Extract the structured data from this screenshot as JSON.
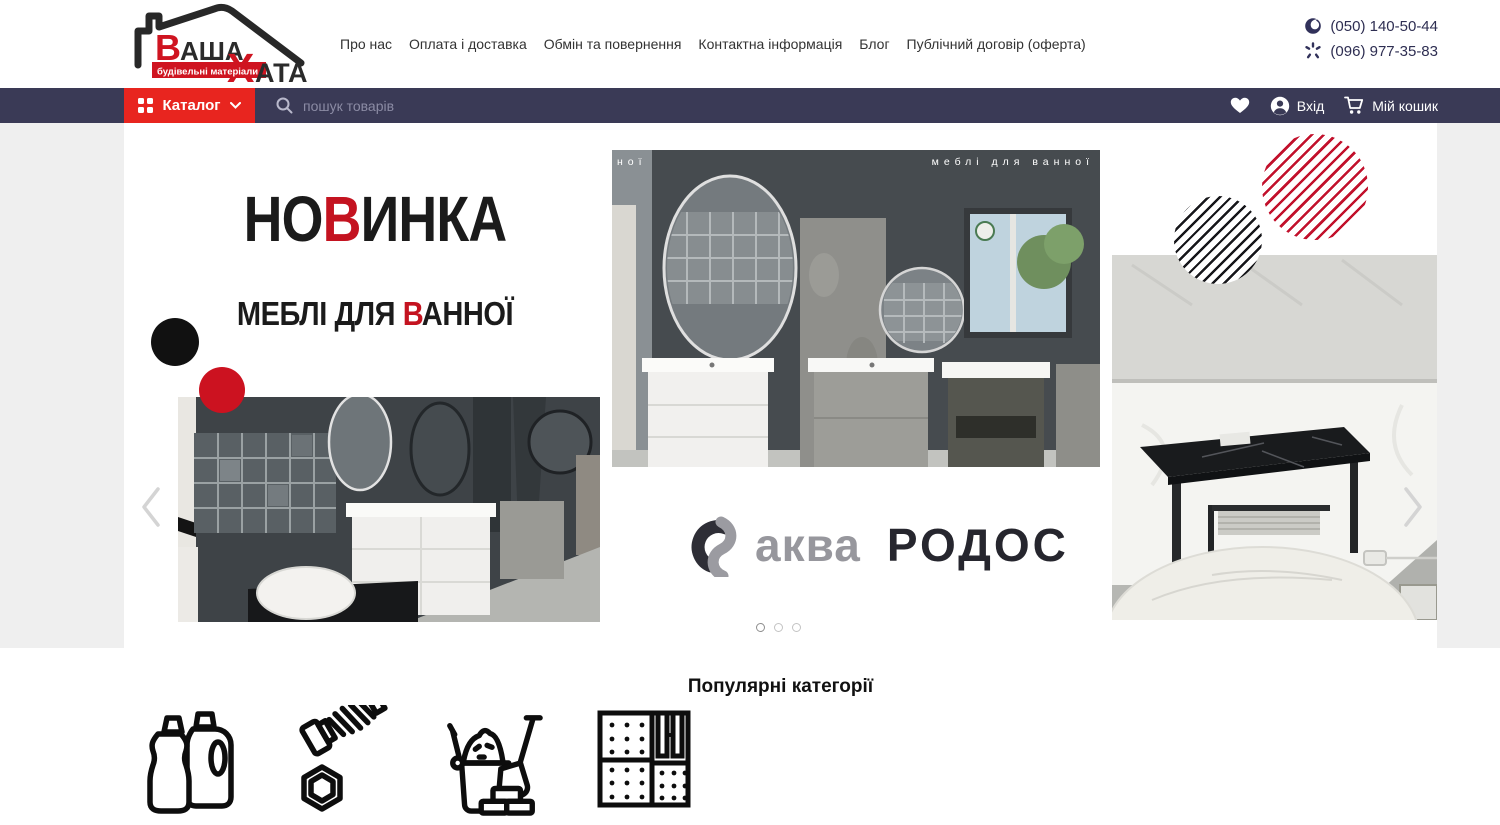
{
  "header": {
    "logo": {
      "word1_accent": "В",
      "word1_rest": "АША",
      "word2_accent": "Х",
      "word2_rest": "АТА",
      "tagline": "будівельні матеріали"
    },
    "nav": [
      {
        "label": "Про нас"
      },
      {
        "label": "Оплата і доставка"
      },
      {
        "label": "Обмін та повернення"
      },
      {
        "label": "Контактна інформація"
      },
      {
        "label": "Блог"
      },
      {
        "label": "Публічний договір (оферта)"
      }
    ],
    "phones": [
      {
        "carrier": "vodafone-icon",
        "number": "(050) 140-50-44"
      },
      {
        "carrier": "kyivstar-icon",
        "number": "(096) 977-35-83"
      }
    ]
  },
  "navbar": {
    "catalog_label": "Каталог",
    "search_placeholder": "пошук товарів",
    "login_label": "Вхід",
    "cart_label": "Мій кошик"
  },
  "hero": {
    "title_pre": "НО",
    "title_accent": "В",
    "title_post": "ИНКА",
    "subtitle_pre": "МЕБЛІ ДЛЯ ",
    "subtitle_accent": "В",
    "subtitle_post": "АННОЇ",
    "photo_caption": "меблі для ванної",
    "photo_caption_fragment": "ної",
    "brand_part1": "аква",
    "brand_part2": "РОДОС",
    "dots_count": 3,
    "active_dot": 1
  },
  "categories": {
    "heading": "Популярні категорії",
    "items": [
      {
        "name": "household-chemicals"
      },
      {
        "name": "fasteners"
      },
      {
        "name": "building-materials"
      },
      {
        "name": "insulation-panels"
      }
    ]
  },
  "colors": {
    "accent_red": "#e8251f",
    "title_red": "#c41320",
    "navbar_dark": "#3a3a56",
    "page_gray": "#efefef"
  }
}
